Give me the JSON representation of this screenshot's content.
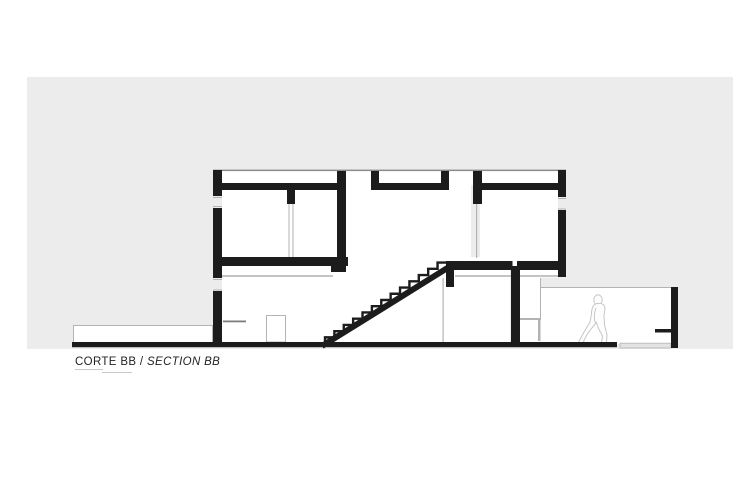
{
  "title": {
    "primary": "CORTE BB",
    "separator": " / ",
    "secondary": "SECTION BB"
  },
  "colors": {
    "page": "#ffffff",
    "sheet": "#ececec",
    "ink": "#1c1c1c",
    "faint_line": "#b3b3b3",
    "mid_line": "#8a8a8a",
    "entourage": "#c6c6c6",
    "step": "#e3e3e3"
  },
  "figures": {
    "person": "walking-person-outline"
  }
}
